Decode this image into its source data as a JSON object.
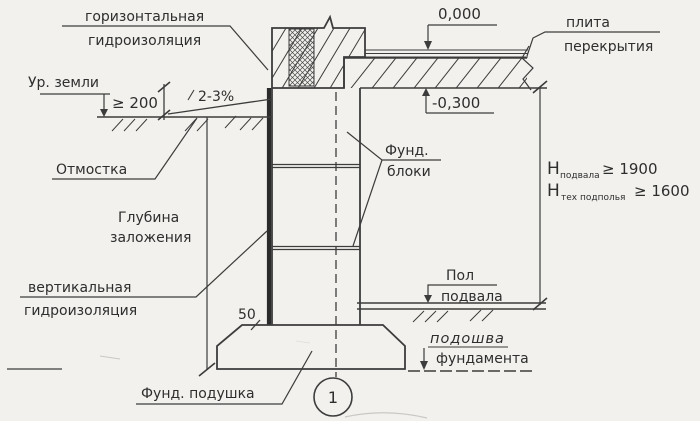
{
  "drawing": {
    "kind": "foundation-wall-section-sketch",
    "colors": {
      "ink": "#3c3c3c",
      "paper": "#f2f1ed"
    }
  },
  "labels": {
    "horiz_wp_1": "горизонтальная",
    "horiz_wp_2": "гидроизоляция",
    "ground_level": "Ур. земли",
    "dim_200": "≥ 200",
    "slope": "2-3%",
    "otmostka": "Отмостка",
    "depth_1": "Глубина",
    "depth_2": "заложения",
    "vert_wp_1": "вертикальная",
    "vert_wp_2": "гидроизоляция",
    "pad": "Фунд. подушка",
    "dim_50": "50",
    "node": "1",
    "elev_zero": "0,000",
    "slab_1": "плита",
    "slab_2": "перекрытия",
    "elev_minus": "-0,300",
    "blocks_1": "Фунд.",
    "blocks_2": "блоки",
    "h1_sym": "H",
    "h1_sub": "подвала",
    "h1_val": "≥ 1900",
    "h2_sym": "H",
    "h2_sub": "тех подполья",
    "h2_val": "≥ 1600",
    "floor_1": "Пол",
    "floor_2": "подвала",
    "sole_1": "подошва",
    "sole_2": "фундамента"
  }
}
